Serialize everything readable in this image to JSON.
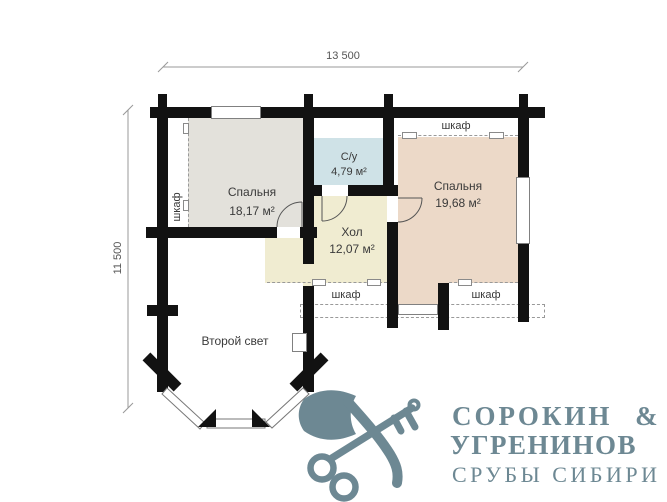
{
  "dimensions": {
    "width_label": "13 500",
    "height_label": "11 500"
  },
  "rooms": {
    "bedroom1": {
      "name": "Спальня",
      "area": "18,17 м²"
    },
    "bathroom": {
      "name": "С/у",
      "area": "4,79 м²"
    },
    "bedroom2": {
      "name": "Спальня",
      "area": "19,68 м²"
    },
    "hall": {
      "name": "Хол",
      "area": "12,07 м²"
    },
    "second_light": {
      "name": "Второй свет"
    }
  },
  "closets": {
    "left": "шкаф",
    "top_right": "шкаф",
    "bottom_left": "шкаф",
    "bottom_right": "шкаф"
  },
  "logo": {
    "line1": "СОРОКИН &",
    "line2": "УГРЕНИНОВ",
    "line3": "СРУБЫ СИБИРИ",
    "color": "#6d8893"
  },
  "colors": {
    "wall": "#121212",
    "bedroom1_fill": "#e3e1db",
    "bedroom2_fill": "#ecd9c8",
    "bathroom_fill": "#cfe2e7",
    "hall_fill": "#f0ecd1",
    "line": "#8a8a8a"
  }
}
